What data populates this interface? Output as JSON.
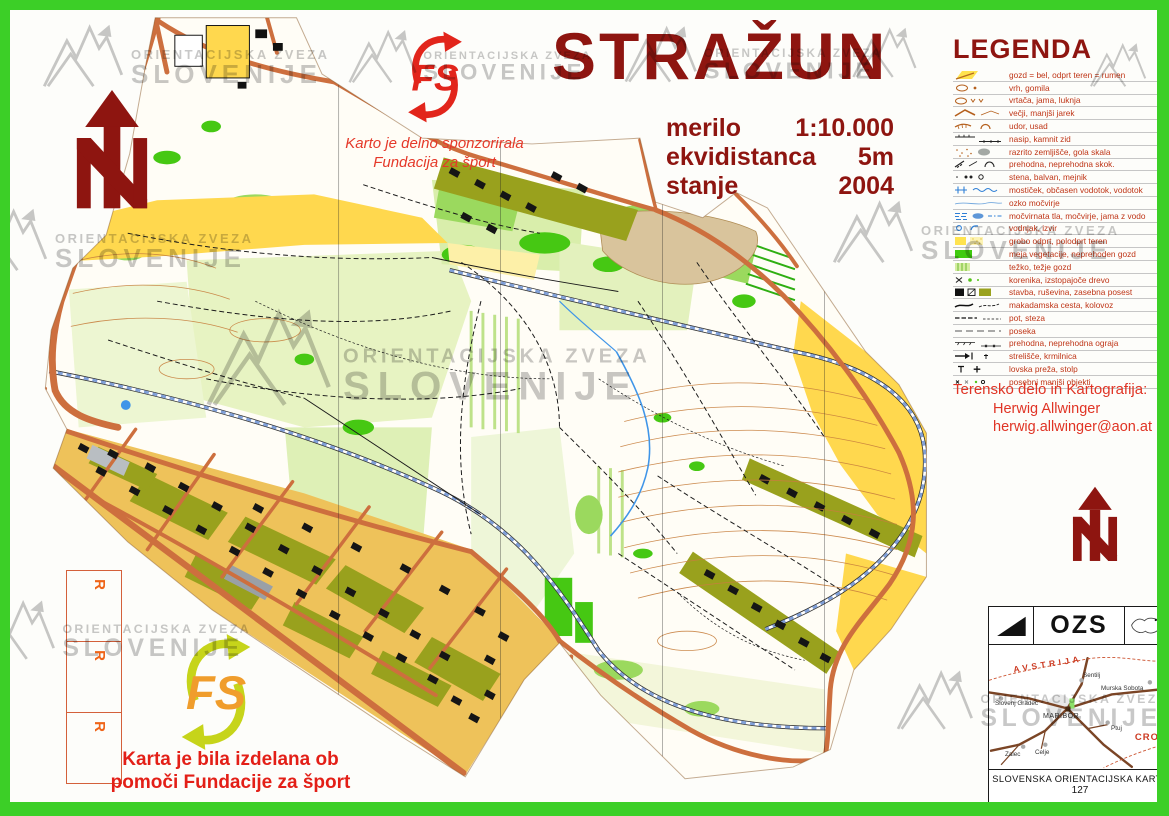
{
  "watermark": {
    "line1": "ORIENTACIJSKA ZVEZA",
    "line2": "SLOVENIJE"
  },
  "title_block": {
    "title": "STRAŽUN",
    "specs": [
      {
        "label": "merilo",
        "value": "1:10.000"
      },
      {
        "label": "ekvidistanca",
        "value": "5m"
      },
      {
        "label": "stanje",
        "value": "2004"
      }
    ]
  },
  "sponsor_top": {
    "logo_text": "FS",
    "line1": "Karto je delno sponzorirala",
    "line2": "Fundacija za šport"
  },
  "sponsor_bottom": {
    "logo_text": "FS",
    "line1": "Karta je bila izdelana ob",
    "line2": "pomoči Fundacije za šport"
  },
  "legend": {
    "title": "LEGENDA",
    "entries": [
      {
        "symbol": "forest-open-icon",
        "label": "gozd = bel, odprt teren = rumen"
      },
      {
        "symbol": "knoll-icon",
        "label": "vrh, gomila"
      },
      {
        "symbol": "depression-icon",
        "label": "vrtača, jama, luknja"
      },
      {
        "symbol": "ditch-icon",
        "label": "večji, manjši jarek"
      },
      {
        "symbol": "erosion-icon",
        "label": "udor, usad"
      },
      {
        "symbol": "wall-icon",
        "label": "nasip, kamnit zid"
      },
      {
        "symbol": "rough-ground-icon",
        "label": "razrito zemljišče, gola skala"
      },
      {
        "symbol": "crossing-icon",
        "label": "prehodna, neprehodna skok."
      },
      {
        "symbol": "boulder-icon",
        "label": "stena, balvan, mejnik"
      },
      {
        "symbol": "stream-icon",
        "label": "mostiček, občasen vodotok, vodotok"
      },
      {
        "symbol": "narrow-marsh-icon",
        "label": "ozko močvirje"
      },
      {
        "symbol": "marsh-icon",
        "label": "močvirnata tla, močvirje, jama z vodo"
      },
      {
        "symbol": "spring-icon",
        "label": "vodnjak, izvir"
      },
      {
        "symbol": "open-land-icon",
        "label": "grobo odprt, polodprt teren"
      },
      {
        "symbol": "vegetation-icon",
        "label": "meja vegetacije, neprehoden gozd"
      },
      {
        "symbol": "thicket-icon",
        "label": "težko, težje gozd"
      },
      {
        "symbol": "root-icon",
        "label": "korenika, izstopajoče drevo"
      },
      {
        "symbol": "building-icon",
        "label": "stavba, ruševina, zasebna posest"
      },
      {
        "symbol": "road-icon",
        "label": "makadamska cesta, kolovoz"
      },
      {
        "symbol": "path-icon",
        "label": "pot, steza"
      },
      {
        "symbol": "ride-icon",
        "label": "poseka"
      },
      {
        "symbol": "fence-icon",
        "label": "prehodna, neprehodna ograja"
      },
      {
        "symbol": "range-icon",
        "label": "strelišče, krmilnica"
      },
      {
        "symbol": "perch-icon",
        "label": "lovska preža, stolp"
      },
      {
        "symbol": "objects-icon",
        "label": "posebni manjši objekti"
      }
    ]
  },
  "credits": {
    "heading": "Terensko delo in Kartografija:",
    "name": "Herwig Allwinger",
    "email": "herwig.allwinger@aon.at"
  },
  "margin_labels": [
    "R",
    "R",
    "R"
  ],
  "info_box": {
    "org": "OZS",
    "countries": [
      {
        "name": "AVSTRIJA"
      },
      {
        "name": "CRO"
      }
    ],
    "towns": [
      "Sentilj",
      "Murska Sobota",
      "Slovenj Gradec",
      "MARIBOR",
      "Ptuj",
      "Zalec",
      "Celje"
    ],
    "footer_title": "SLOVENSKA ORIENTACIJSKA KARTA",
    "footer_number": "127"
  },
  "colors": {
    "frame_green": "#3ccf27",
    "title_red": "#8e1510",
    "sponsor_red": "#e31f17",
    "legend_text_red": "#bf3517",
    "map_yellow": "#ffd84e",
    "map_green": "#46c813",
    "road_orange": "#cd6f3e"
  }
}
